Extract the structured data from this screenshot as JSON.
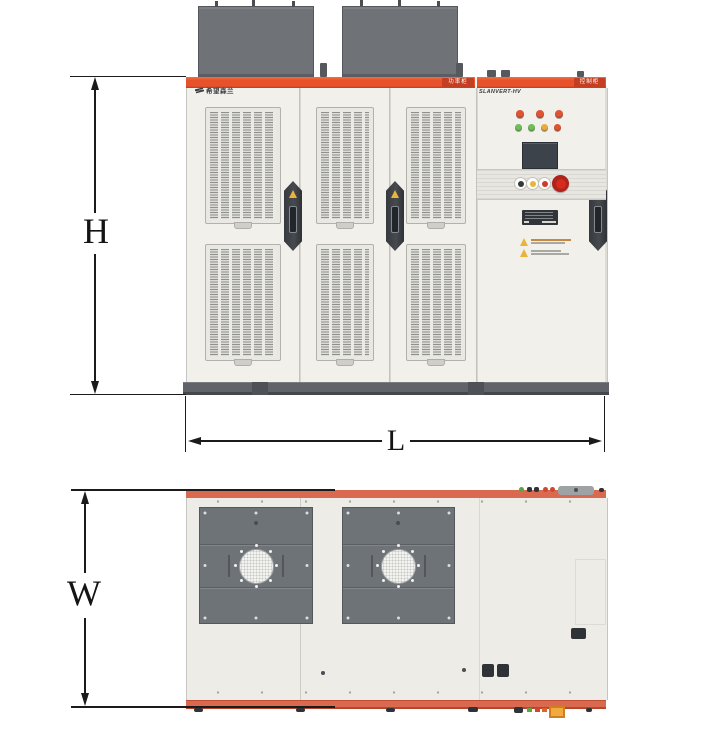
{
  "figure": {
    "dimension_labels": {
      "height": "H",
      "length": "L",
      "width": "W"
    }
  },
  "front_view": {
    "brand_logo_text": "希望森兰",
    "product_model_text": "SLANVERT-HV",
    "power_cabinet_badge": "功率柜",
    "control_cabinet_badge": "控制柜",
    "indicator_lights_row1": [
      "#DF5533",
      "#DF5533",
      "#DF5533"
    ],
    "indicator_lights_row2": [
      "#6FBE58",
      "#6FBE58",
      "#E8AC3C",
      "#DF5533"
    ],
    "pushbutton_colors": [
      "#34383C",
      "#E8B43A",
      "#CE3A2B"
    ],
    "estop_color": "#D62A1E"
  },
  "colors": {
    "header_band_orange": "#E7522B",
    "badge_red": "#C33E22",
    "top_view_strip_salmon": "#D96A4F",
    "cabinet_body": "#F1F0EB",
    "roof_box_gray": "#6F7377",
    "fan_panel_gray": "#6E7377",
    "base_plinth_gray": "#5F6367",
    "dimension_line": "#1B1B1B"
  }
}
